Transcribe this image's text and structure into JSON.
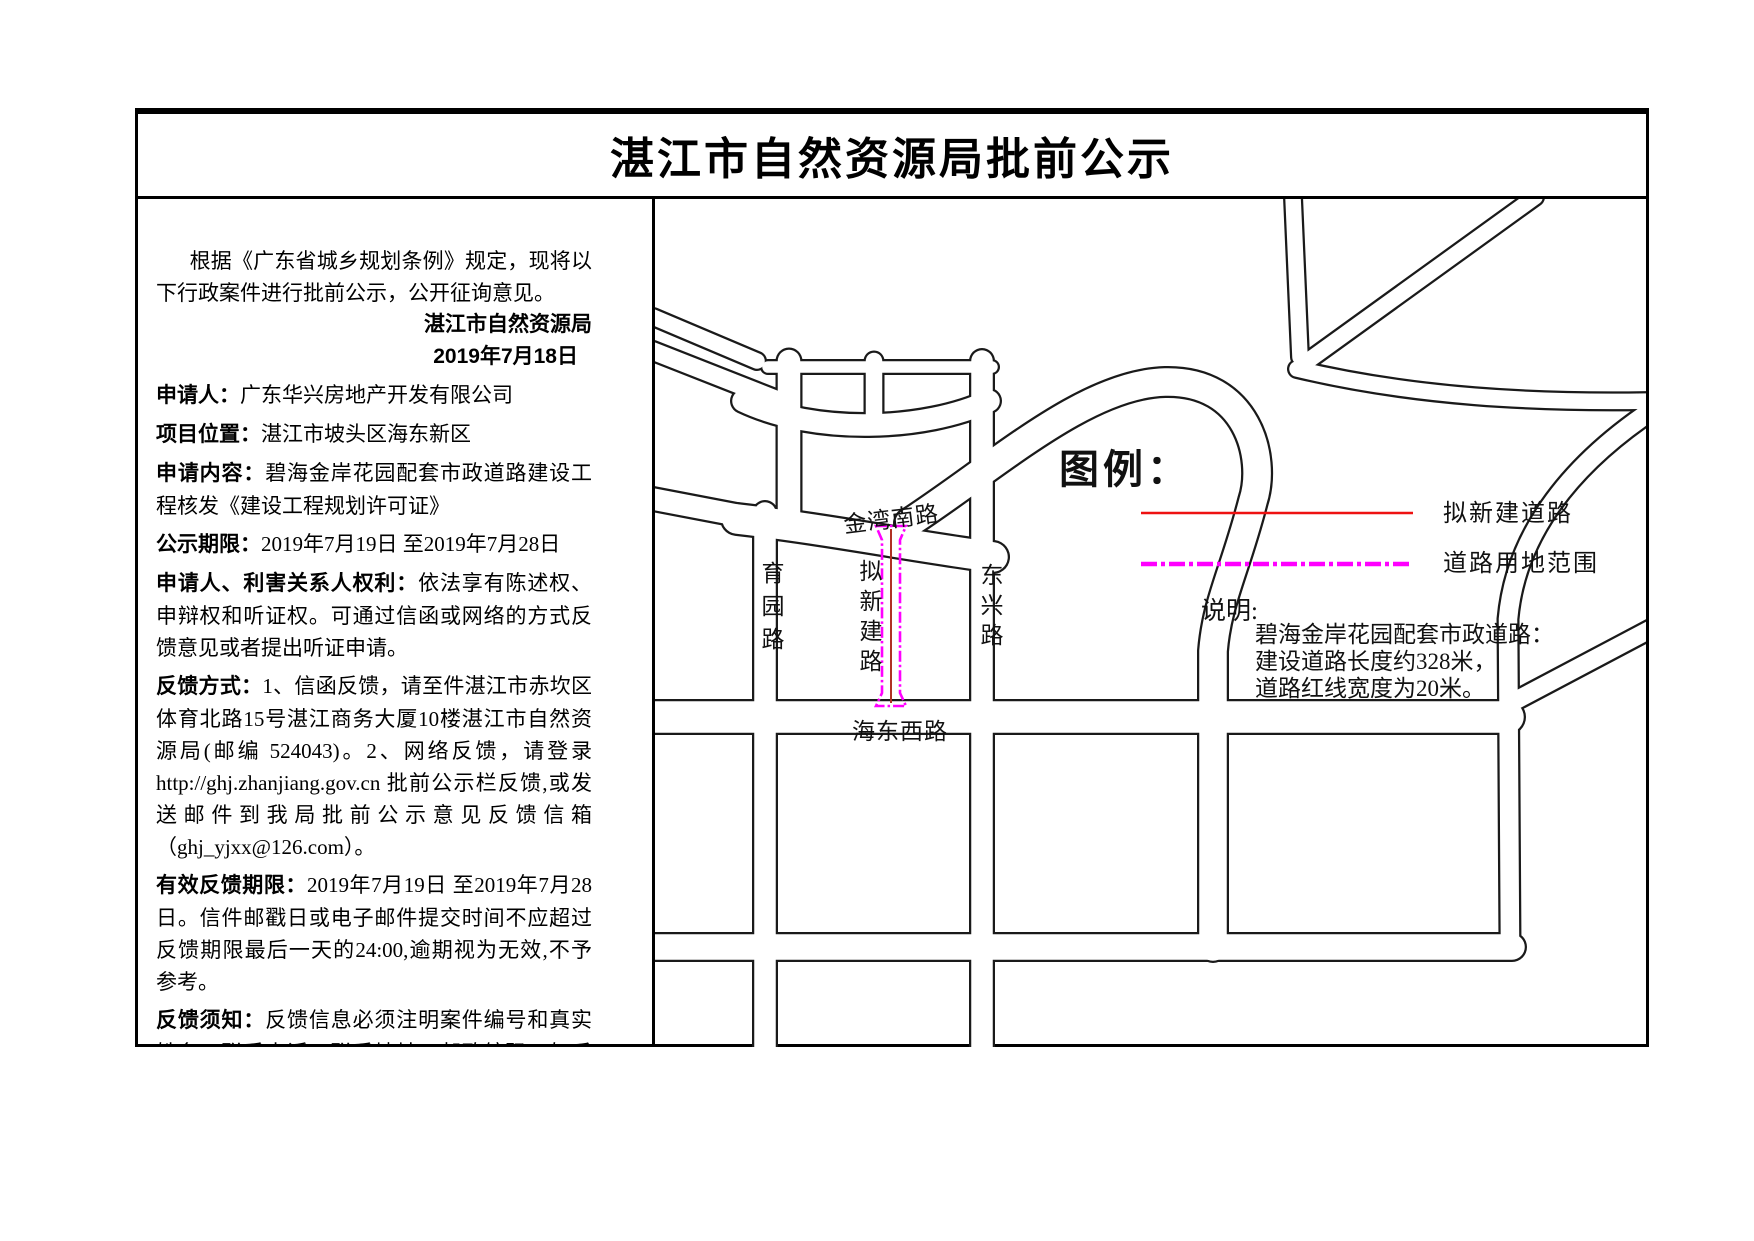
{
  "title": "湛江市自然资源局批前公示",
  "notice": {
    "intro": "根据《广东省城乡规划条例》规定，现将以下行政案件进行批前公示，公开征询意见。",
    "signature": "湛江市自然资源局",
    "date": "2019年7月18日",
    "items": [
      {
        "label": "申请人：",
        "text": "广东华兴房地产开发有限公司"
      },
      {
        "label": "项目位置：",
        "text": "湛江市坡头区海东新区"
      },
      {
        "label": "申请内容：",
        "text": "碧海金岸花园配套市政道路建设工程核发《建设工程规划许可证》"
      },
      {
        "label": "公示期限：",
        "text": "2019年7月19日 至2019年7月28日"
      },
      {
        "label": "申请人、利害关系人权利：",
        "text": "依法享有陈述权、申辩权和听证权。可通过信函或网络的方式反馈意见或者提出听证申请。"
      },
      {
        "label": "反馈方式：",
        "text": "1、信函反馈，请至件湛江市赤坎区体育北路15号湛江商务大厦10楼湛江市自然资源局(邮编 524043)。2、网络反馈，请登录 http://ghj.zhanjiang.gov.cn 批前公示栏反馈,或发送邮件到我局批前公示意见反馈信箱（ghj_yjxx@126.com）。"
      },
      {
        "label": "有效反馈期限：",
        "text": "2019年7月19日 至2019年7月28日。信件邮戳日或电子邮件提交时间不应超过反馈期限最后一天的24:00,逾期视为无效,不予参考。"
      },
      {
        "label": "反馈须知：",
        "text": "反馈信息必须注明案件编号和真实姓名、联系电话、联系地址、邮政编码，如反馈信息不准确或不完整，导致无法核实有关情况的视为无效。"
      }
    ]
  },
  "map": {
    "legend": {
      "title": "图例：",
      "items": [
        {
          "label": "拟新建道路",
          "color": "#ee1111",
          "style": "solid"
        },
        {
          "label": "道路用地范围",
          "color": "#ff00ff",
          "style": "dash-dot"
        }
      ]
    },
    "note": {
      "label": "说明:",
      "lines": [
        "碧海金岸花园配套市政道路：",
        "建设道路长度约328米，",
        "道路红线宽度为20米。"
      ]
    },
    "road_labels": {
      "jinwan_south": "金湾南路",
      "yuyuan": "育园路",
      "dongxing": "东兴路",
      "haidong_west": "海东西路",
      "proposed": "拟新建路"
    },
    "colors": {
      "proposed_centerline": "#b03224",
      "legend_new_road": "#ee1111",
      "road_land_boundary": "#ff00ff",
      "road_outline": "#1a1a1a"
    }
  }
}
